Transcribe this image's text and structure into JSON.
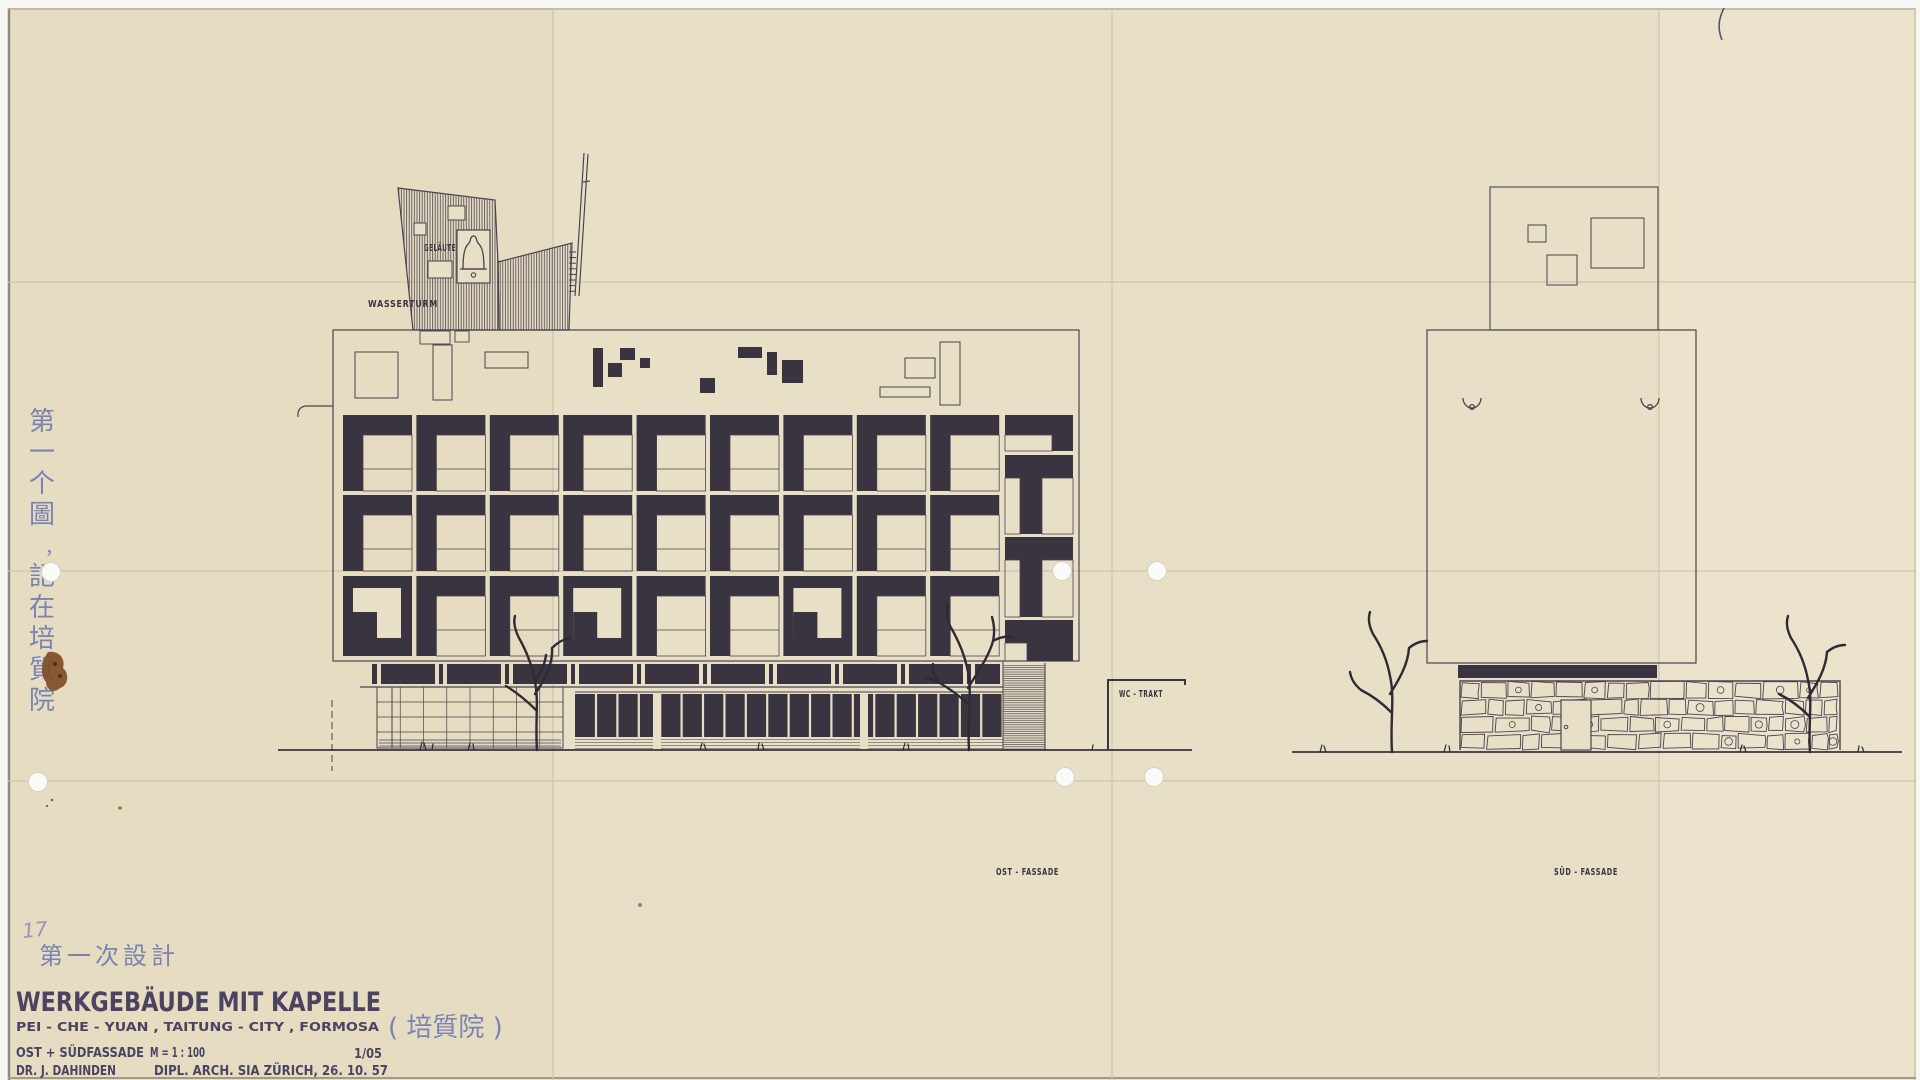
{
  "colors": {
    "paper": "#e8e0c6",
    "ink_dark": "#3a3340",
    "ink_line": "#4a4350",
    "blue_ink": "#7b83b4",
    "title_ink": "#4a4462",
    "pencil": "#a193b4",
    "stain": "#7d4a20",
    "fold": "#cfc6ab",
    "hole": "#fafaf8"
  },
  "labels": {
    "bells": "GELÄUTE",
    "water_tower": "WASSERTURM",
    "wc_wing": "WC - TRAKT",
    "east_facade": "OST - FASSADE",
    "south_facade": "SÜD - FASSADE"
  },
  "title_block": {
    "sheet_number_pencil": "17",
    "note_cn": "第一次設計",
    "title": "WERKGEBÄUDE MIT KAPELLE",
    "subtitle": "PEI - CHE - YUAN , TAITUNG - CITY , FORMOSA",
    "subtitle_cn": "( 培質院 )",
    "views": "OST + SÜDFASSADE",
    "scale": "M = 1 : 100",
    "sheet": "1/05",
    "author": "DR. J. DAHINDEN",
    "credentials": "DIPL. ARCH. SIA  ZÜRICH, 26. 10. 57"
  },
  "side_note_cn_vertical": "第一个圖，記在培質院",
  "facade": {
    "columns": 9,
    "rows": 3,
    "ring_row": 2,
    "ring_columns": [
      0,
      3,
      6
    ]
  }
}
